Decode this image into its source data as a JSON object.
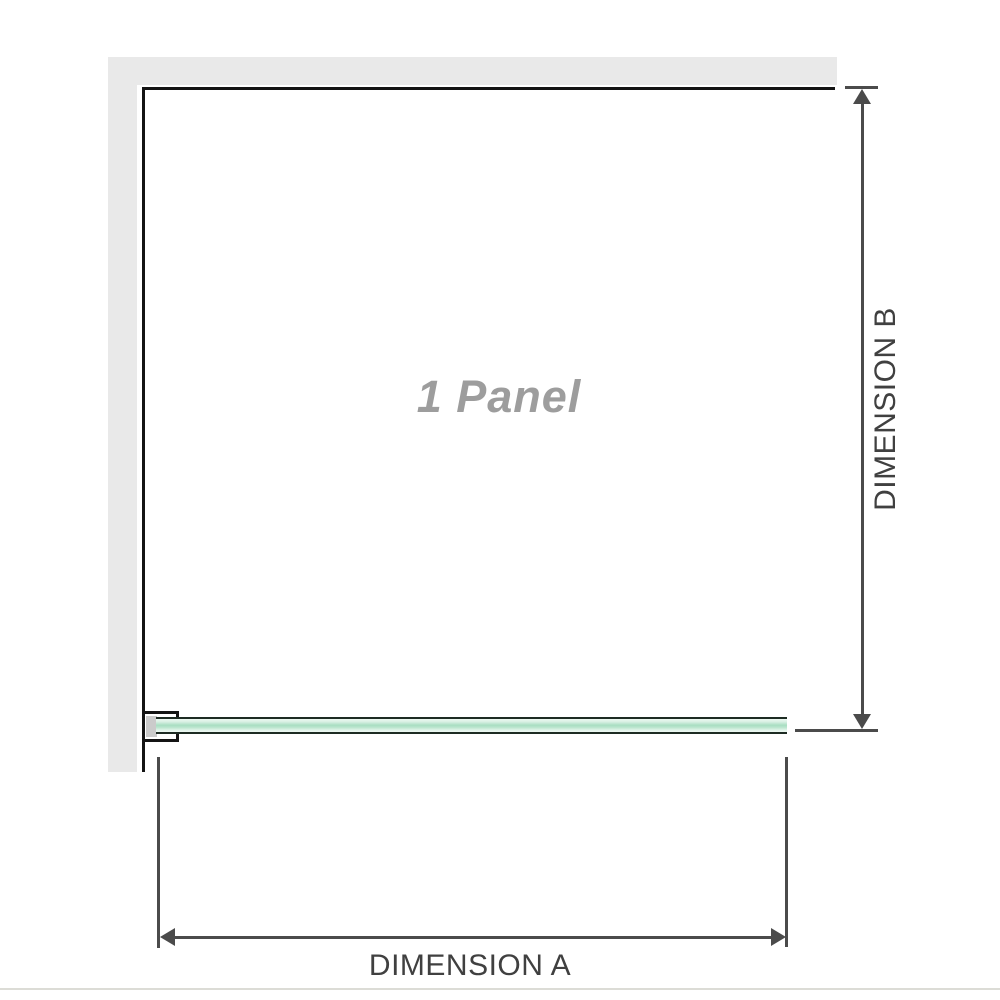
{
  "diagram": {
    "panel_label": "1 Panel",
    "dimension_a_label": "DIMENSION A",
    "dimension_b_label": "DIMENSION B"
  },
  "colors": {
    "wall": "#e9e9e9",
    "outline": "#141414",
    "dim_line": "#4b4b4b",
    "label_text": "#404040",
    "panel_text": "#9d9d9d",
    "glass_light": "#eef8f2",
    "glass_mid": "#a9dec2",
    "glass_edge": "#1d2b23",
    "bracket_pad": "#cbcbcb",
    "baseline": "#dcdcd6"
  }
}
